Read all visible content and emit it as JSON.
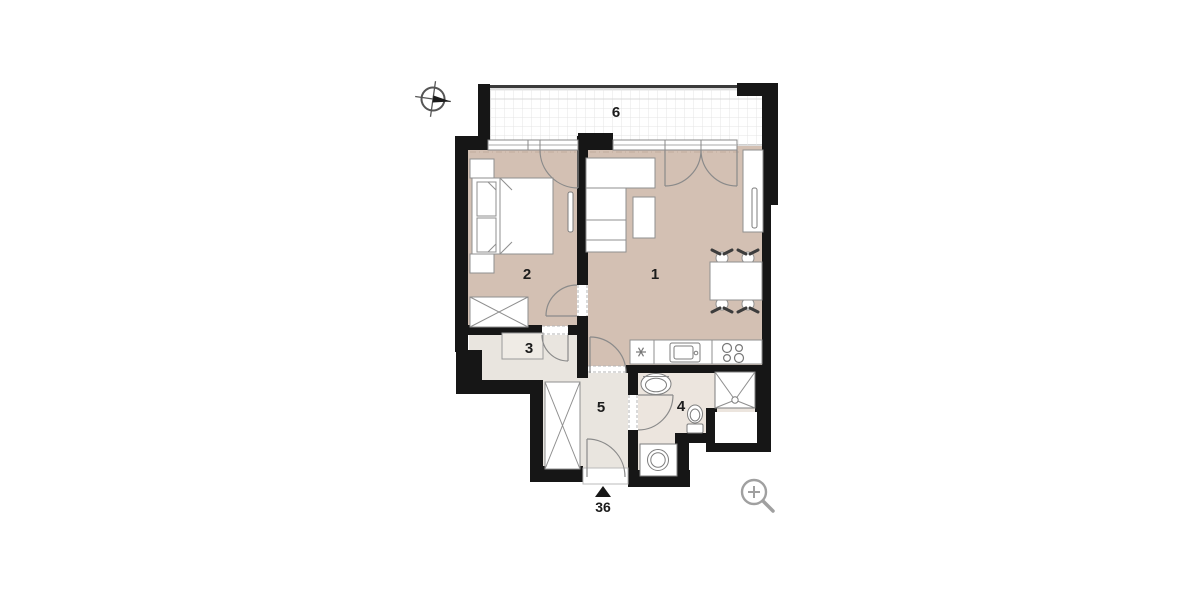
{
  "plan_type": "apartment-floor-plan",
  "rooms": [
    {
      "number": "1",
      "name": "living-room-with-kitchen"
    },
    {
      "number": "2",
      "name": "bedroom"
    },
    {
      "number": "3",
      "name": "walk-in-closet"
    },
    {
      "number": "4",
      "name": "bathroom"
    },
    {
      "number": "5",
      "name": "entrance-hall"
    },
    {
      "number": "6",
      "name": "balcony"
    }
  ],
  "entrance": {
    "number": "36",
    "marker": "triangle-up"
  },
  "icons": {
    "compass": "north-compass-icon",
    "zoom": "zoom-in-icon"
  },
  "symbols": [
    "bed",
    "nightstand",
    "pillow",
    "wardrobe",
    "radiator",
    "sofa",
    "coffee-table",
    "dining-table",
    "chair",
    "tall-cabinet",
    "kitchen-counter",
    "kitchen-sink",
    "stove",
    "dishwasher-marker",
    "shelf",
    "bathroom-sink",
    "toilet",
    "shower",
    "washing-machine",
    "window",
    "door-swing",
    "balcony-railing",
    "tiled-floor"
  ],
  "colors": {
    "wall": "#161616",
    "floor_main": "#d3c0b3",
    "floor_secondary": "#e9e5df",
    "floor_bath": "#ece5de",
    "shelf_fill": "#efebe5",
    "outline": "#8f8f8f",
    "balcony_grid": "#e4e4e4",
    "background": "#ffffff"
  }
}
